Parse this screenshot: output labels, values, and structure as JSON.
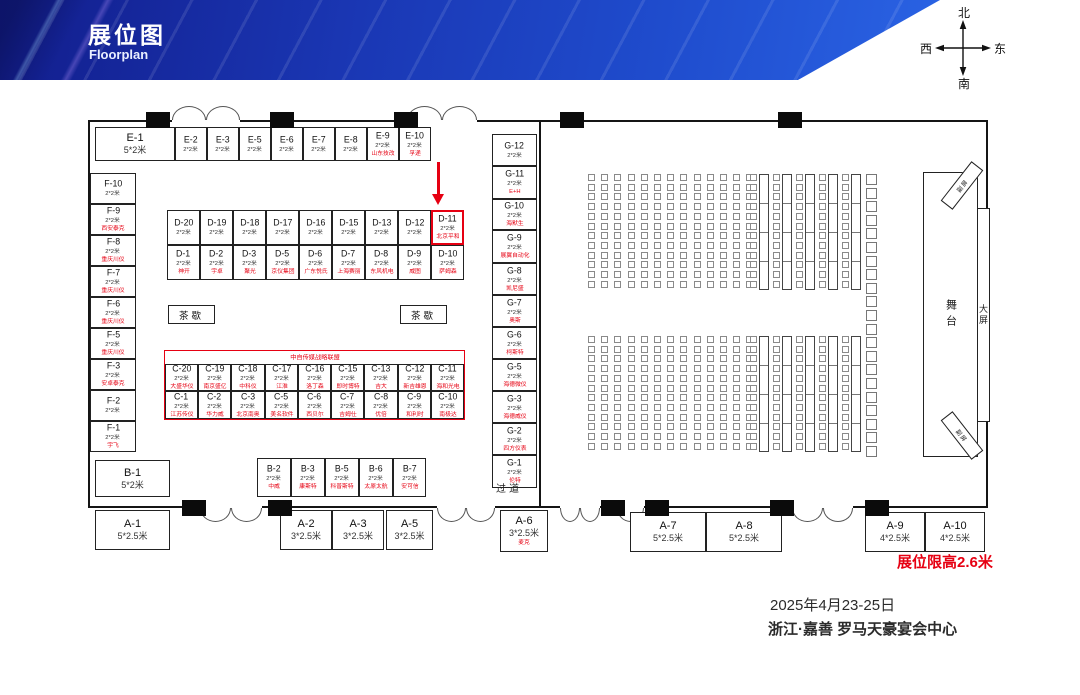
{
  "header": {
    "title": "展位图",
    "subtitle": "Floorplan"
  },
  "compass": {
    "north": "北",
    "south": "南",
    "west": "西",
    "east": "东"
  },
  "labels": {
    "c_banner": "中自传媒战略联盟",
    "tea_break": "茶歇",
    "aisle": "过道",
    "stage": "舞台",
    "main_screen": "大屏",
    "side_screen": "副屏"
  },
  "notes": {
    "height_limit": "展位限高2.6米",
    "date": "2025年4月23-25日",
    "venue": "浙江·嘉善 罗马天豪宴会中心"
  },
  "booths": [
    {
      "id": "E-1",
      "size": "5*2米",
      "rect": [
        95,
        127,
        80,
        34
      ],
      "big": true
    },
    {
      "id": "E-2",
      "size": "2*2米",
      "rect": [
        175,
        127,
        32,
        34
      ]
    },
    {
      "id": "E-3",
      "size": "2*2米",
      "rect": [
        207,
        127,
        32,
        34
      ]
    },
    {
      "id": "E-5",
      "size": "2*2米",
      "rect": [
        239,
        127,
        32,
        34
      ]
    },
    {
      "id": "E-6",
      "size": "2*2米",
      "rect": [
        271,
        127,
        32,
        34
      ]
    },
    {
      "id": "E-7",
      "size": "2*2米",
      "rect": [
        303,
        127,
        32,
        34
      ]
    },
    {
      "id": "E-8",
      "size": "2*2米",
      "rect": [
        335,
        127,
        32,
        34
      ]
    },
    {
      "id": "E-9",
      "size": "2*2米",
      "company": "山东技改",
      "rect": [
        367,
        127,
        32,
        34
      ]
    },
    {
      "id": "E-10",
      "size": "2*2米",
      "company": "孚递",
      "rect": [
        399,
        127,
        32,
        34
      ]
    },
    {
      "id": "F-10",
      "size": "2*2米",
      "rect": [
        90,
        173,
        46,
        31
      ]
    },
    {
      "id": "F-9",
      "size": "2*2米",
      "company": "西安泰克",
      "rect": [
        90,
        204,
        46,
        31
      ]
    },
    {
      "id": "F-8",
      "size": "2*2米",
      "company": "重庆川仪",
      "rect": [
        90,
        235,
        46,
        31
      ]
    },
    {
      "id": "F-7",
      "size": "2*2米",
      "company": "重庆川仪",
      "rect": [
        90,
        266,
        46,
        31
      ]
    },
    {
      "id": "F-6",
      "size": "2*2米",
      "company": "重庆川仪",
      "rect": [
        90,
        297,
        46,
        31
      ]
    },
    {
      "id": "F-5",
      "size": "2*2米",
      "company": "重庆川仪",
      "rect": [
        90,
        328,
        46,
        31
      ]
    },
    {
      "id": "F-3",
      "size": "2*2米",
      "company": "安卓泰克",
      "rect": [
        90,
        359,
        46,
        31
      ]
    },
    {
      "id": "F-2",
      "size": "2*2米",
      "rect": [
        90,
        390,
        46,
        31
      ]
    },
    {
      "id": "F-1",
      "size": "2*2米",
      "company": "宇飞",
      "rect": [
        90,
        421,
        46,
        31
      ]
    },
    {
      "id": "D-20",
      "size": "2*2米",
      "rect": [
        167,
        210,
        33,
        35
      ]
    },
    {
      "id": "D-19",
      "size": "2*2米",
      "rect": [
        200,
        210,
        33,
        35
      ]
    },
    {
      "id": "D-18",
      "size": "2*2米",
      "rect": [
        233,
        210,
        33,
        35
      ]
    },
    {
      "id": "D-17",
      "size": "2*2米",
      "rect": [
        266,
        210,
        33,
        35
      ]
    },
    {
      "id": "D-16",
      "size": "2*2米",
      "rect": [
        299,
        210,
        33,
        35
      ]
    },
    {
      "id": "D-15",
      "size": "2*2米",
      "rect": [
        332,
        210,
        33,
        35
      ]
    },
    {
      "id": "D-13",
      "size": "2*2米",
      "rect": [
        365,
        210,
        33,
        35
      ]
    },
    {
      "id": "D-12",
      "size": "2*2米",
      "rect": [
        398,
        210,
        33,
        35
      ]
    },
    {
      "id": "D-11",
      "size": "2*2米",
      "company": "北京平和",
      "rect": [
        431,
        210,
        33,
        35
      ],
      "highlight": true
    },
    {
      "id": "D-1",
      "size": "2*2米",
      "company": "神开",
      "rect": [
        167,
        245,
        33,
        35
      ]
    },
    {
      "id": "D-2",
      "size": "2*2米",
      "company": "宇卓",
      "rect": [
        200,
        245,
        33,
        35
      ]
    },
    {
      "id": "D-3",
      "size": "2*2米",
      "company": "聚光",
      "rect": [
        233,
        245,
        33,
        35
      ]
    },
    {
      "id": "D-5",
      "size": "2*2米",
      "company": "京仪集团",
      "rect": [
        266,
        245,
        33,
        35
      ]
    },
    {
      "id": "D-6",
      "size": "2*2米",
      "company": "广东悦氏",
      "rect": [
        299,
        245,
        33,
        35
      ]
    },
    {
      "id": "D-7",
      "size": "2*2米",
      "company": "上海赛丽",
      "rect": [
        332,
        245,
        33,
        35
      ]
    },
    {
      "id": "D-8",
      "size": "2*2米",
      "company": "东风机电",
      "rect": [
        365,
        245,
        33,
        35
      ]
    },
    {
      "id": "D-9",
      "size": "2*2米",
      "company": "威图",
      "rect": [
        398,
        245,
        33,
        35
      ]
    },
    {
      "id": "D-10",
      "size": "2*2米",
      "company": "萨姆森",
      "rect": [
        431,
        245,
        33,
        35
      ]
    },
    {
      "id": "C-20",
      "size": "2*2米",
      "company": "大盛华仪",
      "rect": [
        165,
        364,
        33,
        27
      ]
    },
    {
      "id": "C-19",
      "size": "2*2米",
      "company": "南京盛亿",
      "rect": [
        198,
        364,
        33,
        27
      ]
    },
    {
      "id": "C-18",
      "size": "2*2米",
      "company": "中科仪",
      "rect": [
        231,
        364,
        34,
        27
      ]
    },
    {
      "id": "C-17",
      "size": "2*2米",
      "company": "江淮",
      "rect": [
        265,
        364,
        33,
        27
      ]
    },
    {
      "id": "C-16",
      "size": "2*2米",
      "company": "洛丁森",
      "rect": [
        298,
        364,
        33,
        27
      ]
    },
    {
      "id": "C-15",
      "size": "2*2米",
      "company": "即时博特",
      "rect": [
        331,
        364,
        33,
        27
      ]
    },
    {
      "id": "C-13",
      "size": "2*2米",
      "company": "吉大",
      "rect": [
        364,
        364,
        34,
        27
      ]
    },
    {
      "id": "C-12",
      "size": "2*2米",
      "company": "新吉雄恩",
      "rect": [
        398,
        364,
        33,
        27
      ]
    },
    {
      "id": "C-11",
      "size": "2*2米",
      "company": "海和光电",
      "rect": [
        431,
        364,
        33,
        27
      ]
    },
    {
      "id": "C-1",
      "size": "2*2米",
      "company": "江苏传仪",
      "rect": [
        165,
        391,
        33,
        28
      ]
    },
    {
      "id": "C-2",
      "size": "2*2米",
      "company": "华力威",
      "rect": [
        198,
        391,
        33,
        28
      ]
    },
    {
      "id": "C-3",
      "size": "2*2米",
      "company": "北京南奥",
      "rect": [
        231,
        391,
        34,
        28
      ]
    },
    {
      "id": "C-5",
      "size": "2*2米",
      "company": "美名软件",
      "rect": [
        265,
        391,
        33,
        28
      ]
    },
    {
      "id": "C-6",
      "size": "2*2米",
      "company": "西贝尔",
      "rect": [
        298,
        391,
        33,
        28
      ]
    },
    {
      "id": "C-7",
      "size": "2*2米",
      "company": "吉姆仕",
      "rect": [
        331,
        391,
        33,
        28
      ]
    },
    {
      "id": "C-8",
      "size": "2*2米",
      "company": "优倍",
      "rect": [
        364,
        391,
        34,
        28
      ]
    },
    {
      "id": "C-9",
      "size": "2*2米",
      "company": "和利时",
      "rect": [
        398,
        391,
        33,
        28
      ]
    },
    {
      "id": "C-10",
      "size": "2*2米",
      "company": "南极达",
      "rect": [
        431,
        391,
        33,
        28
      ]
    },
    {
      "id": "B-1",
      "size": "5*2米",
      "rect": [
        95,
        460,
        75,
        37
      ],
      "big": true
    },
    {
      "id": "B-2",
      "size": "2*2米",
      "company": "中威",
      "rect": [
        257,
        458,
        34,
        39
      ]
    },
    {
      "id": "B-3",
      "size": "2*2米",
      "company": "康斯特",
      "rect": [
        291,
        458,
        34,
        39
      ]
    },
    {
      "id": "B-5",
      "size": "2*2米",
      "company": "科普斯特",
      "rect": [
        325,
        458,
        34,
        39
      ]
    },
    {
      "id": "B-6",
      "size": "2*2米",
      "company": "太原太航",
      "rect": [
        359,
        458,
        34,
        39
      ]
    },
    {
      "id": "B-7",
      "size": "2*2米",
      "company": "安可信",
      "rect": [
        393,
        458,
        33,
        39
      ]
    },
    {
      "id": "A-1",
      "size": "5*2.5米",
      "rect": [
        95,
        510,
        75,
        40
      ],
      "big": true
    },
    {
      "id": "A-2",
      "size": "3*2.5米",
      "rect": [
        280,
        510,
        52,
        40
      ],
      "big": true
    },
    {
      "id": "A-3",
      "size": "3*2.5米",
      "rect": [
        332,
        510,
        52,
        40
      ],
      "big": true
    },
    {
      "id": "A-5",
      "size": "3*2.5米",
      "rect": [
        386,
        510,
        47,
        40
      ],
      "big": true
    },
    {
      "id": "A-6",
      "size": "3*2.5米",
      "company": "麦克",
      "rect": [
        500,
        510,
        48,
        42
      ],
      "big": true
    },
    {
      "id": "A-7",
      "size": "5*2.5米",
      "rect": [
        630,
        512,
        76,
        40
      ],
      "big": true
    },
    {
      "id": "A-8",
      "size": "5*2.5米",
      "rect": [
        706,
        512,
        76,
        40
      ],
      "big": true
    },
    {
      "id": "A-9",
      "size": "4*2.5米",
      "rect": [
        865,
        512,
        60,
        40
      ],
      "big": true
    },
    {
      "id": "A-10",
      "size": "4*2.5米",
      "rect": [
        925,
        512,
        60,
        40
      ],
      "big": true
    },
    {
      "id": "G-12",
      "size": "2*2米",
      "rect": [
        492,
        134,
        45,
        32
      ]
    },
    {
      "id": "G-11",
      "size": "2*2米",
      "company": "E+H",
      "rect": [
        492,
        166,
        45,
        33
      ]
    },
    {
      "id": "G-10",
      "size": "2*2米",
      "company": "海默生",
      "rect": [
        492,
        199,
        45,
        31
      ]
    },
    {
      "id": "G-9",
      "size": "2*2米",
      "company": "展翼自动化",
      "rect": [
        492,
        230,
        45,
        33
      ]
    },
    {
      "id": "G-8",
      "size": "2*2米",
      "company": "凯尼盛",
      "rect": [
        492,
        263,
        45,
        32
      ]
    },
    {
      "id": "G-7",
      "size": "2*2米",
      "company": "奥斯",
      "rect": [
        492,
        295,
        45,
        32
      ]
    },
    {
      "id": "G-6",
      "size": "2*2米",
      "company": "柯斯特",
      "rect": [
        492,
        327,
        45,
        32
      ]
    },
    {
      "id": "G-5",
      "size": "2*2米",
      "company": "海德微仪",
      "rect": [
        492,
        359,
        45,
        32
      ]
    },
    {
      "id": "G-3",
      "size": "2*2米",
      "company": "海德威仪",
      "rect": [
        492,
        391,
        45,
        32
      ]
    },
    {
      "id": "G-2",
      "size": "2*2米",
      "company": "四方仪表",
      "rect": [
        492,
        423,
        45,
        32
      ]
    },
    {
      "id": "G-1",
      "size": "2*2米",
      "company": "伦特",
      "rect": [
        492,
        455,
        45,
        33
      ]
    }
  ],
  "tea_boxes": [
    [
      168,
      305,
      47,
      19
    ],
    [
      400,
      305,
      47,
      19
    ]
  ],
  "structure": {
    "pillars_top": [
      146,
      270,
      394,
      560,
      778
    ],
    "pillars_bottom": [
      182,
      268,
      601,
      645,
      770,
      865
    ],
    "doors_top": [
      {
        "x": 172,
        "w": 68
      },
      {
        "x": 407,
        "w": 70
      }
    ],
    "doors_bottom": [
      {
        "x": 200,
        "w": 62
      },
      {
        "x": 437,
        "w": 58
      },
      {
        "x": 560,
        "w": 40
      },
      {
        "x": 617,
        "w": 27
      },
      {
        "x": 792,
        "w": 61
      }
    ]
  },
  "seating": {
    "blocks": [
      {
        "y": 174
      },
      {
        "y": 336
      }
    ],
    "rows": 12,
    "row_h": 9.7,
    "chair_cols": 13,
    "col_x0": 588,
    "col_w": 13.2,
    "groups": {
      "x0": 750,
      "spacing": 23,
      "count": 5,
      "table_offset": 9,
      "table_w": 10
    },
    "big_col": {
      "x": 866,
      "y0": 174,
      "count": 21,
      "step": 13.6
    }
  }
}
